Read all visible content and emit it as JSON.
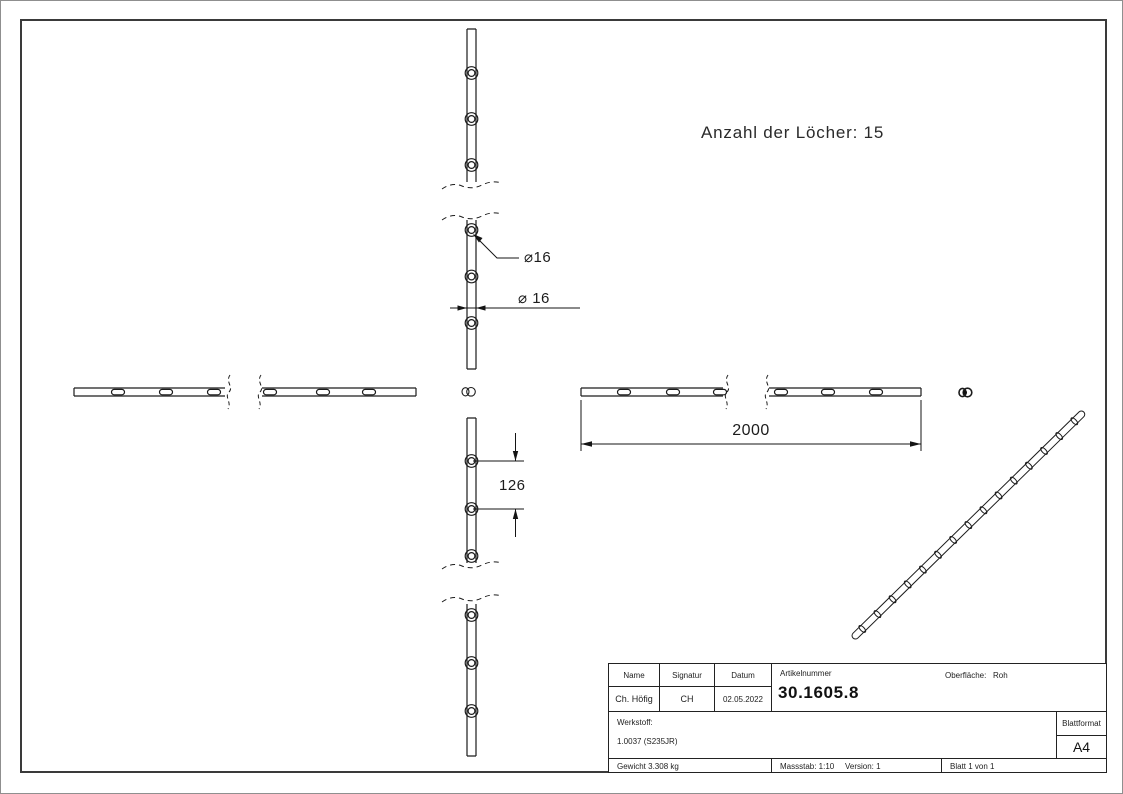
{
  "drawing": {
    "note": "Anzahl der Löcher: 15",
    "dimensions": {
      "hole_diameter_detail": "⌀16",
      "bar_diameter": "⌀ 16",
      "total_length": "2000",
      "hole_spacing": "126"
    },
    "title_block": {
      "col_name": "Name",
      "col_signatur": "Signatur",
      "col_datum": "Datum",
      "name": "Ch. Höfig",
      "signatur": "CH",
      "datum": "02.05.2022",
      "artikelnummer_label": "Artikelnummer",
      "artikelnummer": "30.1605.8",
      "oberflaeche_label": "Oberfläche:",
      "oberflaeche": "Roh",
      "werkstoff_label": "Werkstoff:",
      "werkstoff": "1.0037 (S235JR)",
      "blattformat_label": "Blattformat",
      "blattformat": "A4",
      "gewicht": "Gewicht 3.308 kg",
      "massstab": "Massstab: 1:10",
      "version": "Version: 1",
      "blatt": "Blatt 1 von 1"
    }
  }
}
